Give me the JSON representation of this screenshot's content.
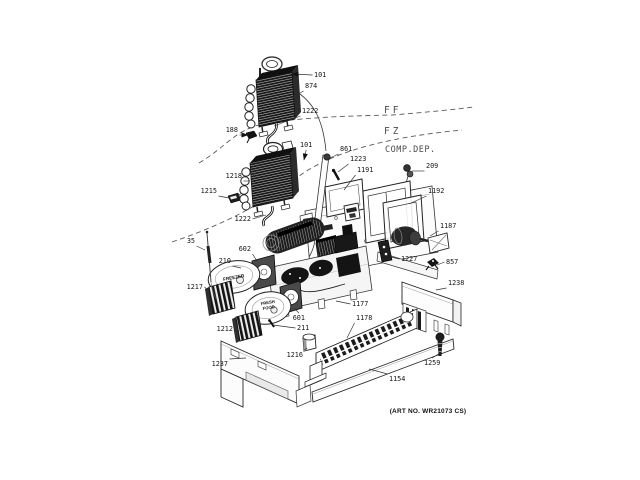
{
  "figure": {
    "art_no": "(ART NO. WR21073 CS)",
    "zone_labels": [
      {
        "label": "FF",
        "x": 384,
        "y": 113
      },
      {
        "label": "FZ",
        "x": 384,
        "y": 134
      },
      {
        "label": "COMP.DEP.",
        "x": 385,
        "y": 152
      }
    ],
    "equipment_labels": [
      {
        "text": "FREEZER",
        "x": 234,
        "y": 279,
        "rot": -10,
        "size": 4.6
      },
      {
        "text": "FRESH",
        "x": 268,
        "y": 304,
        "rot": -10,
        "size": 4.2
      },
      {
        "text": "FOOD",
        "x": 269,
        "y": 309,
        "rot": -10,
        "size": 4.2
      }
    ],
    "callouts": [
      {
        "part": "101",
        "lx": 314,
        "ly": 77,
        "anchor": "start",
        "tx": 292,
        "ty": 74,
        "arrow": true
      },
      {
        "part": "874",
        "lx": 305,
        "ly": 88,
        "anchor": "start",
        "tx": 291,
        "ty": 98
      },
      {
        "part": "1222",
        "lx": 302,
        "ly": 113,
        "anchor": "start",
        "tx": 274,
        "ty": 126
      },
      {
        "part": "188",
        "lx": 238,
        "ly": 132,
        "anchor": "end",
        "tx": 248,
        "ty": 135,
        "arrow": true
      },
      {
        "part": "101",
        "lx": 300,
        "ly": 147,
        "anchor": "start",
        "tx": 304,
        "ty": 160,
        "arrow": true
      },
      {
        "part": "861",
        "lx": 340,
        "ly": 151,
        "anchor": "start",
        "tx": 330,
        "ty": 158
      },
      {
        "part": "1223",
        "lx": 350,
        "ly": 161,
        "anchor": "start",
        "tx": 338,
        "ty": 172
      },
      {
        "part": "1191",
        "lx": 357,
        "ly": 172,
        "anchor": "start",
        "tx": 344,
        "ty": 190
      },
      {
        "part": "209",
        "lx": 426,
        "ly": 168,
        "anchor": "start",
        "tx": 412,
        "ty": 171
      },
      {
        "part": "1218",
        "lx": 242,
        "ly": 178,
        "anchor": "end",
        "tx": 249,
        "ty": 181
      },
      {
        "part": "1215",
        "lx": 217,
        "ly": 193,
        "anchor": "end",
        "tx": 229,
        "ty": 198
      },
      {
        "part": "1192",
        "lx": 428,
        "ly": 193,
        "anchor": "start",
        "tx": 409,
        "ty": 204
      },
      {
        "part": "1222",
        "lx": 251,
        "ly": 221,
        "anchor": "end",
        "tx": 266,
        "ty": 215
      },
      {
        "part": "1187",
        "lx": 440,
        "ly": 228,
        "anchor": "start",
        "tx": 430,
        "ty": 236
      },
      {
        "part": "35",
        "lx": 195,
        "ly": 243,
        "anchor": "end",
        "tx": 205,
        "ty": 250
      },
      {
        "part": "602",
        "lx": 251,
        "ly": 251,
        "anchor": "end",
        "tx": 257,
        "ty": 261
      },
      {
        "part": "210",
        "lx": 231,
        "ly": 263,
        "anchor": "end",
        "tx": 241,
        "ty": 268
      },
      {
        "part": "1227",
        "lx": 401,
        "ly": 261,
        "anchor": "start",
        "tx": 391,
        "ty": 257
      },
      {
        "part": "857",
        "lx": 446,
        "ly": 264,
        "anchor": "start",
        "tx": 437,
        "ty": 265
      },
      {
        "part": "1238",
        "lx": 448,
        "ly": 285,
        "anchor": "start",
        "tx": 436,
        "ty": 290
      },
      {
        "part": "1217",
        "lx": 203,
        "ly": 289,
        "anchor": "end",
        "tx": 209,
        "ty": 291
      },
      {
        "part": "1177",
        "lx": 352,
        "ly": 306,
        "anchor": "start",
        "tx": 336,
        "ty": 301
      },
      {
        "part": "1178",
        "lx": 356,
        "ly": 320,
        "anchor": "start",
        "tx": 347,
        "ty": 338
      },
      {
        "part": "601",
        "lx": 305,
        "ly": 320,
        "anchor": "end",
        "tx": 294,
        "ty": 308
      },
      {
        "part": "1212",
        "lx": 233,
        "ly": 331,
        "anchor": "end",
        "tx": 241,
        "ty": 323
      },
      {
        "part": "211",
        "lx": 297,
        "ly": 330,
        "anchor": "start",
        "tx": 273,
        "ty": 325
      },
      {
        "part": "1216",
        "lx": 303,
        "ly": 357,
        "anchor": "end",
        "tx": 307,
        "ty": 348
      },
      {
        "part": "1237",
        "lx": 228,
        "ly": 366,
        "anchor": "end",
        "tx": 246,
        "ty": 358
      },
      {
        "part": "1259",
        "lx": 424,
        "ly": 365,
        "anchor": "start",
        "tx": 440,
        "ty": 353
      },
      {
        "part": "1154",
        "lx": 389,
        "ly": 381,
        "anchor": "start",
        "tx": 369,
        "ty": 369
      }
    ]
  }
}
